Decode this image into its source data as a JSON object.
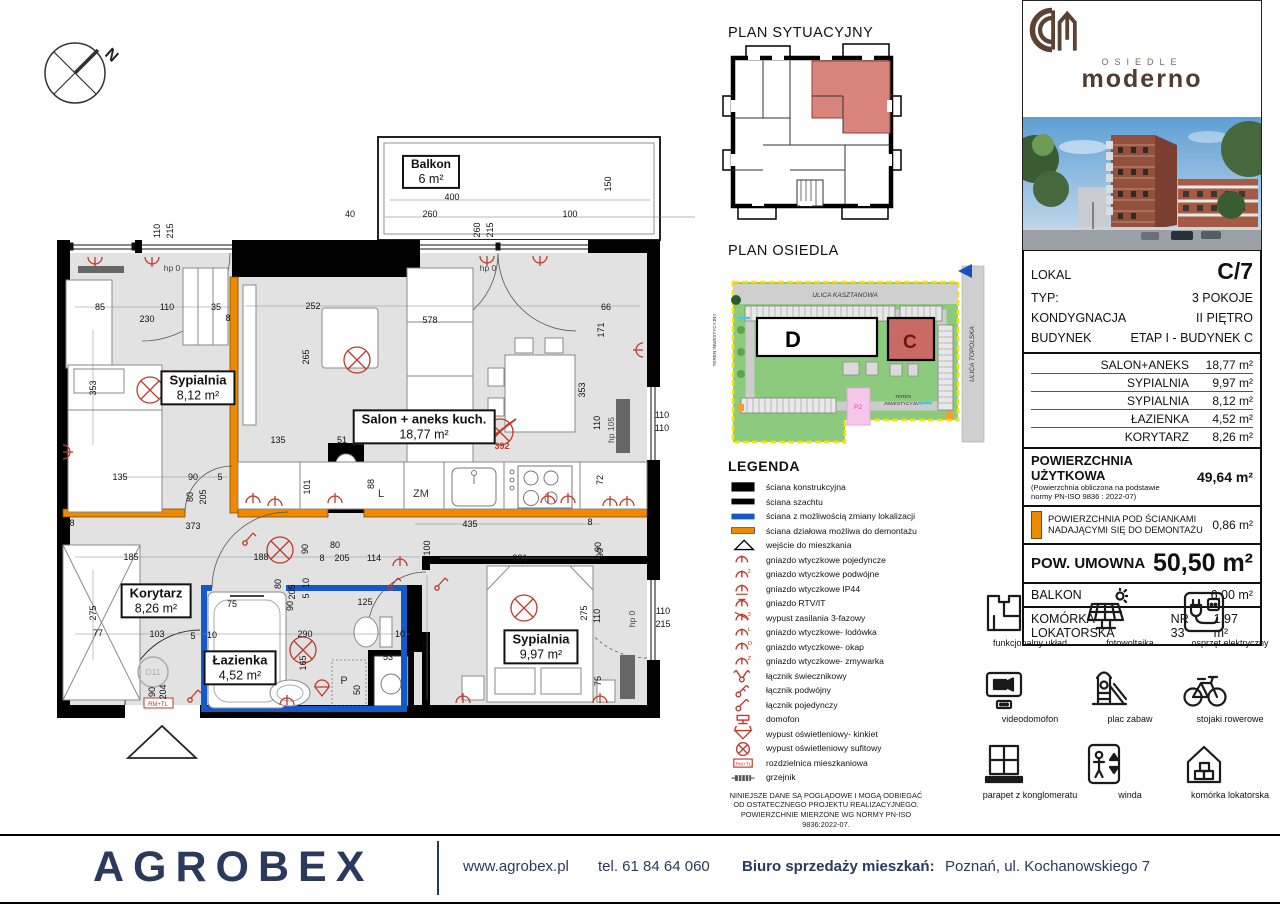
{
  "compass": {
    "north": "N"
  },
  "titles": {
    "plan_sytuacyjny": "PLAN SYTUACYJNY",
    "plan_osiedla": "PLAN OSIEDLA"
  },
  "osiedle": {
    "street_top": "ULICA KASZTANOWA",
    "street_right": "ULICA TOPOLSKA",
    "teren_left": "TEREN INWESTYCYJNY",
    "teren_bottom_1": "TEREN",
    "teren_bottom_2": "INWESTYCYJNY",
    "building_d": "D",
    "building_c": "C",
    "p2": "P2"
  },
  "floor_plan": {
    "rooms": [
      {
        "name": "Balkon",
        "area": "6 m²",
        "cx": 431,
        "cy": 172,
        "small": true
      },
      {
        "name": "Sypialnia",
        "area": "8,12 m²",
        "cx": 198,
        "cy": 388
      },
      {
        "name": "Salon + aneks kuch.",
        "area": "18,77 m²",
        "cx": 424,
        "cy": 427
      },
      {
        "name": "Korytarz",
        "area": "8,26 m²",
        "cx": 156,
        "cy": 601
      },
      {
        "name": "Łazienka",
        "area": "4,52 m²",
        "cx": 240,
        "cy": 668
      },
      {
        "name": "Sypialnia",
        "area": "9,97 m²",
        "cx": 541,
        "cy": 647
      }
    ],
    "badges": [
      {
        "t": "RM+TL"
      },
      {
        "t": "D11"
      },
      {
        "t": "392"
      }
    ],
    "dims": [
      {
        "t": "400",
        "x": 452,
        "y": 197
      },
      {
        "t": "40",
        "x": 350,
        "y": 214
      },
      {
        "t": "260",
        "x": 430,
        "y": 214
      },
      {
        "t": "100",
        "x": 570,
        "y": 214
      },
      {
        "t": "150",
        "x": 608,
        "y": 184,
        "r": 1
      },
      {
        "t": "260",
        "x": 477,
        "y": 230,
        "r": 1
      },
      {
        "t": "215",
        "x": 490,
        "y": 230,
        "r": 1
      },
      {
        "t": "110",
        "x": 157,
        "y": 231,
        "r": 1
      },
      {
        "t": "215",
        "x": 170,
        "y": 231,
        "r": 1
      },
      {
        "t": "hp 0",
        "x": 172,
        "y": 268,
        "c": "hp"
      },
      {
        "t": "hp 0",
        "x": 488,
        "y": 268,
        "c": "hp"
      },
      {
        "t": "85",
        "x": 100,
        "y": 307
      },
      {
        "t": "230",
        "x": 147,
        "y": 319
      },
      {
        "t": "110",
        "x": 167,
        "y": 307
      },
      {
        "t": "35",
        "x": 216,
        "y": 307
      },
      {
        "t": "8",
        "x": 228,
        "y": 318
      },
      {
        "t": "252",
        "x": 313,
        "y": 306
      },
      {
        "t": "578",
        "x": 430,
        "y": 320
      },
      {
        "t": "66",
        "x": 606,
        "y": 307
      },
      {
        "t": "171",
        "x": 601,
        "y": 330,
        "r": 1
      },
      {
        "t": "353",
        "x": 93,
        "y": 388,
        "r": 1
      },
      {
        "t": "265",
        "x": 306,
        "y": 357,
        "r": 1
      },
      {
        "t": "353",
        "x": 582,
        "y": 390,
        "r": 1
      },
      {
        "t": "110",
        "x": 597,
        "y": 423,
        "r": 1
      },
      {
        "t": "hp 105",
        "x": 611,
        "y": 430,
        "r": 1,
        "c": "hp"
      },
      {
        "t": "110",
        "x": 662,
        "y": 415
      },
      {
        "t": "110",
        "x": 662,
        "y": 428
      },
      {
        "t": "135",
        "x": 278,
        "y": 440
      },
      {
        "t": "51",
        "x": 342,
        "y": 440
      },
      {
        "t": "101",
        "x": 307,
        "y": 487,
        "r": 1
      },
      {
        "t": "88",
        "x": 371,
        "y": 484,
        "r": 1
      },
      {
        "t": "435",
        "x": 470,
        "y": 524
      },
      {
        "t": "8",
        "x": 590,
        "y": 522
      },
      {
        "t": "72",
        "x": 600,
        "y": 480,
        "r": 1
      },
      {
        "t": "90",
        "x": 600,
        "y": 553,
        "r": 1
      },
      {
        "t": "100",
        "x": 427,
        "y": 548,
        "r": 1
      },
      {
        "t": "90",
        "x": 193,
        "y": 477
      },
      {
        "t": "5",
        "x": 220,
        "y": 477
      },
      {
        "t": "80",
        "x": 190,
        "y": 497,
        "r": 1
      },
      {
        "t": "205",
        "x": 203,
        "y": 497,
        "r": 1
      },
      {
        "t": "135",
        "x": 120,
        "y": 477
      },
      {
        "t": "373",
        "x": 193,
        "y": 526
      },
      {
        "t": "8",
        "x": 72,
        "y": 523
      },
      {
        "t": "185",
        "x": 131,
        "y": 557
      },
      {
        "t": "188",
        "x": 261,
        "y": 557
      },
      {
        "t": "90",
        "x": 305,
        "y": 549,
        "r": 1
      },
      {
        "t": "80",
        "x": 335,
        "y": 545
      },
      {
        "t": "8",
        "x": 322,
        "y": 558
      },
      {
        "t": "205",
        "x": 342,
        "y": 558
      },
      {
        "t": "114",
        "x": 374,
        "y": 558
      },
      {
        "t": "80",
        "x": 278,
        "y": 584,
        "r": 1
      },
      {
        "t": "205",
        "x": 292,
        "y": 592,
        "r": 1
      },
      {
        "t": "10",
        "x": 306,
        "y": 583,
        "r": 1
      },
      {
        "t": "5",
        "x": 306,
        "y": 596,
        "r": 1
      },
      {
        "t": "90",
        "x": 290,
        "y": 606,
        "r": 1
      },
      {
        "t": "75",
        "x": 232,
        "y": 604
      },
      {
        "t": "125",
        "x": 365,
        "y": 602
      },
      {
        "t": "103",
        "x": 157,
        "y": 634
      },
      {
        "t": "77",
        "x": 98,
        "y": 633
      },
      {
        "t": "275",
        "x": 93,
        "y": 613,
        "r": 1
      },
      {
        "t": "5",
        "x": 193,
        "y": 636
      },
      {
        "t": "10",
        "x": 212,
        "y": 635
      },
      {
        "t": "290",
        "x": 305,
        "y": 634
      },
      {
        "t": "10",
        "x": 400,
        "y": 634
      },
      {
        "t": "53",
        "x": 388,
        "y": 657
      },
      {
        "t": "165",
        "x": 303,
        "y": 663,
        "r": 1
      },
      {
        "t": "90",
        "x": 152,
        "y": 692,
        "r": 1
      },
      {
        "t": "204",
        "x": 163,
        "y": 692,
        "r": 1
      },
      {
        "t": "50",
        "x": 357,
        "y": 690,
        "r": 1
      },
      {
        "t": "321",
        "x": 520,
        "y": 558
      },
      {
        "t": "90",
        "x": 598,
        "y": 547,
        "r": 1
      },
      {
        "t": "275",
        "x": 584,
        "y": 613,
        "r": 1
      },
      {
        "t": "110",
        "x": 597,
        "y": 616,
        "r": 1
      },
      {
        "t": "175",
        "x": 427,
        "y": 646,
        "r": 1
      },
      {
        "t": "75",
        "x": 598,
        "y": 681,
        "r": 1
      },
      {
        "t": "110",
        "x": 663,
        "y": 611
      },
      {
        "t": "215",
        "x": 663,
        "y": 624
      },
      {
        "t": "hp 0",
        "x": 632,
        "y": 619,
        "r": 1,
        "c": "hp"
      },
      {
        "t": "L",
        "x": 381,
        "y": 494,
        "c": "app"
      },
      {
        "t": "ZM",
        "x": 421,
        "y": 494,
        "c": "app"
      },
      {
        "t": "P",
        "x": 344,
        "y": 681,
        "c": "app"
      }
    ],
    "symbols": [
      {
        "k": "lamp",
        "x": 150,
        "y": 390
      },
      {
        "k": "lamp",
        "x": 357,
        "y": 360
      },
      {
        "k": "lampx",
        "x": 500,
        "y": 432
      },
      {
        "k": "lamp",
        "x": 280,
        "y": 550
      },
      {
        "k": "lamp",
        "x": 303,
        "y": 650
      },
      {
        "k": "lamp",
        "x": 524,
        "y": 608
      },
      {
        "k": "sock",
        "x": 95,
        "y": 260,
        "r": 180
      },
      {
        "k": "sock",
        "x": 152,
        "y": 260,
        "r": 180
      },
      {
        "k": "sock",
        "x": 487,
        "y": 259,
        "r": 180
      },
      {
        "k": "sock",
        "x": 540,
        "y": 259,
        "r": 180
      },
      {
        "k": "sock",
        "x": 66,
        "y": 452,
        "r": 90
      },
      {
        "k": "sock",
        "x": 275,
        "y": 503
      },
      {
        "k": "sock",
        "x": 253,
        "y": 500
      },
      {
        "k": "sock",
        "x": 335,
        "y": 500
      },
      {
        "k": "sock",
        "x": 548,
        "y": 500
      },
      {
        "k": "sock",
        "x": 568,
        "y": 500
      },
      {
        "k": "sock",
        "x": 610,
        "y": 503
      },
      {
        "k": "sock",
        "x": 627,
        "y": 503
      },
      {
        "k": "sw",
        "x": 390,
        "y": 585
      },
      {
        "k": "sock",
        "x": 400,
        "y": 563
      },
      {
        "k": "sw",
        "x": 190,
        "y": 697
      },
      {
        "k": "kink",
        "x": 322,
        "y": 690
      },
      {
        "k": "sock",
        "x": 287,
        "y": 702
      },
      {
        "k": "sock",
        "x": 463,
        "y": 700
      },
      {
        "k": "sock",
        "x": 600,
        "y": 700
      },
      {
        "k": "sw",
        "x": 437,
        "y": 585
      },
      {
        "k": "sock",
        "x": 640,
        "y": 350,
        "r": 270
      },
      {
        "k": "sw",
        "x": 245,
        "y": 540
      }
    ]
  },
  "legend": {
    "title": "LEGENDA",
    "items": [
      {
        "icon": "wall-k",
        "label": "ściana konstrukcyjna"
      },
      {
        "icon": "wall-sz",
        "label": "ściana szachtu"
      },
      {
        "icon": "wall-blue",
        "label": "ściana z możliwością zmiany lokalizacji"
      },
      {
        "icon": "wall-or",
        "label": "ściana działowa możliwa do demontażu"
      },
      {
        "icon": "entry",
        "label": "wejście do mieszkania"
      },
      {
        "icon": "sock",
        "label": "gniazdo wtyczkowe pojedyncze"
      },
      {
        "icon": "sock2",
        "label": "gniazdo wtyczkowe podwójne"
      },
      {
        "icon": "sockip",
        "label": "gniazdo wtyczkowe IP44"
      },
      {
        "icon": "rtv",
        "label": "gniazdo RTV/IT"
      },
      {
        "icon": "faz3",
        "label": "wypust zasilania 3-fazowy"
      },
      {
        "icon": "lod",
        "label": "gniazdo wtyczkowe- lodówka"
      },
      {
        "icon": "okap",
        "label": "gniazdo wtyczkowe- okap"
      },
      {
        "icon": "zmyw",
        "label": "gniazdo wtyczkowe- zmywarka"
      },
      {
        "icon": "swk",
        "label": "łącznik świecznikowy"
      },
      {
        "icon": "sw2",
        "label": "łącznik podwójny"
      },
      {
        "icon": "sw1",
        "label": "łącznik pojedynczy"
      },
      {
        "icon": "dom",
        "label": "domofon"
      },
      {
        "icon": "kink",
        "label": "wypust oświetleniowy- kinkiet"
      },
      {
        "icon": "sufit",
        "label": "wypust oświetleniowy sufitowy"
      },
      {
        "icon": "rozdz",
        "label": "rozdzielnica  mieszkaniowa"
      },
      {
        "icon": "grzej",
        "label": "grzejnik"
      }
    ],
    "disclaimer_1": "NINIEJSZE DANE SĄ POGLĄDOWE I MOGĄ ODBIEGAĆ",
    "disclaimer_2": "OD OSTATECZNEGO PROJEKTU REALIZACYJNEGO.",
    "disclaimer_3": "POWIERZCHNIE MIERZONE WG NORMY PN-ISO 9836:2022-07."
  },
  "brand": {
    "osiedle": "OSIEDLE",
    "name": "moderno"
  },
  "details": {
    "info": [
      {
        "label": "LOKAL",
        "value": "C/7",
        "big": true
      },
      {
        "label": "TYP:",
        "value": "3 POKOJE"
      },
      {
        "label": "KONDYGNACJA",
        "value": "II PIĘTRO"
      },
      {
        "label": "BUDYNEK",
        "value": "ETAP I - BUDYNEK C"
      }
    ],
    "areas": [
      {
        "name": "SALON+ANEKS",
        "value": "18,77 m²"
      },
      {
        "name": "SYPIALNIA",
        "value": "9,97 m²"
      },
      {
        "name": "SYPIALNIA",
        "value": "8,12 m²"
      },
      {
        "name": "ŁAZIENKA",
        "value": "4,52 m²"
      },
      {
        "name": "KORYTARZ",
        "value": "8,26 m²"
      }
    ],
    "usable": {
      "label": "POWIERZCHNIA UŻYTKOWA",
      "note_1": "(Powierzchnia obliczona na podstawie",
      "note_2": "normy PN-ISO 9836 : 2022-07)",
      "value": "49,64 m²"
    },
    "demontaz": {
      "label_1": "POWIERZCHNIA POD ŚCIANKAMI",
      "label_2": "NADAJĄCYMI SIĘ DO DEMONTAŻU",
      "value": "0,86 m²"
    },
    "umowna": {
      "label": "POW. UMOWNA",
      "value": "50,50 m²"
    },
    "balkon": {
      "label": "BALKON",
      "value": "6,00 m²"
    },
    "komorka": {
      "label": "KOMÓRKA LOKATORSKA",
      "nr": "NR 33",
      "value": "1,97 m²"
    }
  },
  "features": [
    {
      "icon": "uklad",
      "label": "funkcjonalny układ"
    },
    {
      "icon": "foto",
      "label": "fotowoltaika"
    },
    {
      "icon": "osprzet",
      "label": "osprzęt elektryczny"
    },
    {
      "icon": "video",
      "label": "videodomofon"
    },
    {
      "icon": "zabaw",
      "label": "plac zabaw"
    },
    {
      "icon": "rower",
      "label": "stojaki rowerowe"
    },
    {
      "icon": "parapet",
      "label": "parapet z konglomeratu"
    },
    {
      "icon": "winda",
      "label": "winda"
    },
    {
      "icon": "komorka",
      "label": "komórka lokatorska"
    }
  ],
  "footer": {
    "logo": "AGROBEX",
    "website": "www.agrobex.pl",
    "phone": "tel. 61 84 64 060",
    "office_label": "Biuro  sprzedaży  mieszkań:",
    "office_address": "Poznań,  ul. Kochanowskiego  7"
  },
  "colors": {
    "navy": "#2b3a5c",
    "orange": "#ef8a00",
    "blue_wall": "#1558c8",
    "red_symbol": "#c0392b",
    "brand_brown": "#503c31",
    "highlight": "#d9837d"
  }
}
